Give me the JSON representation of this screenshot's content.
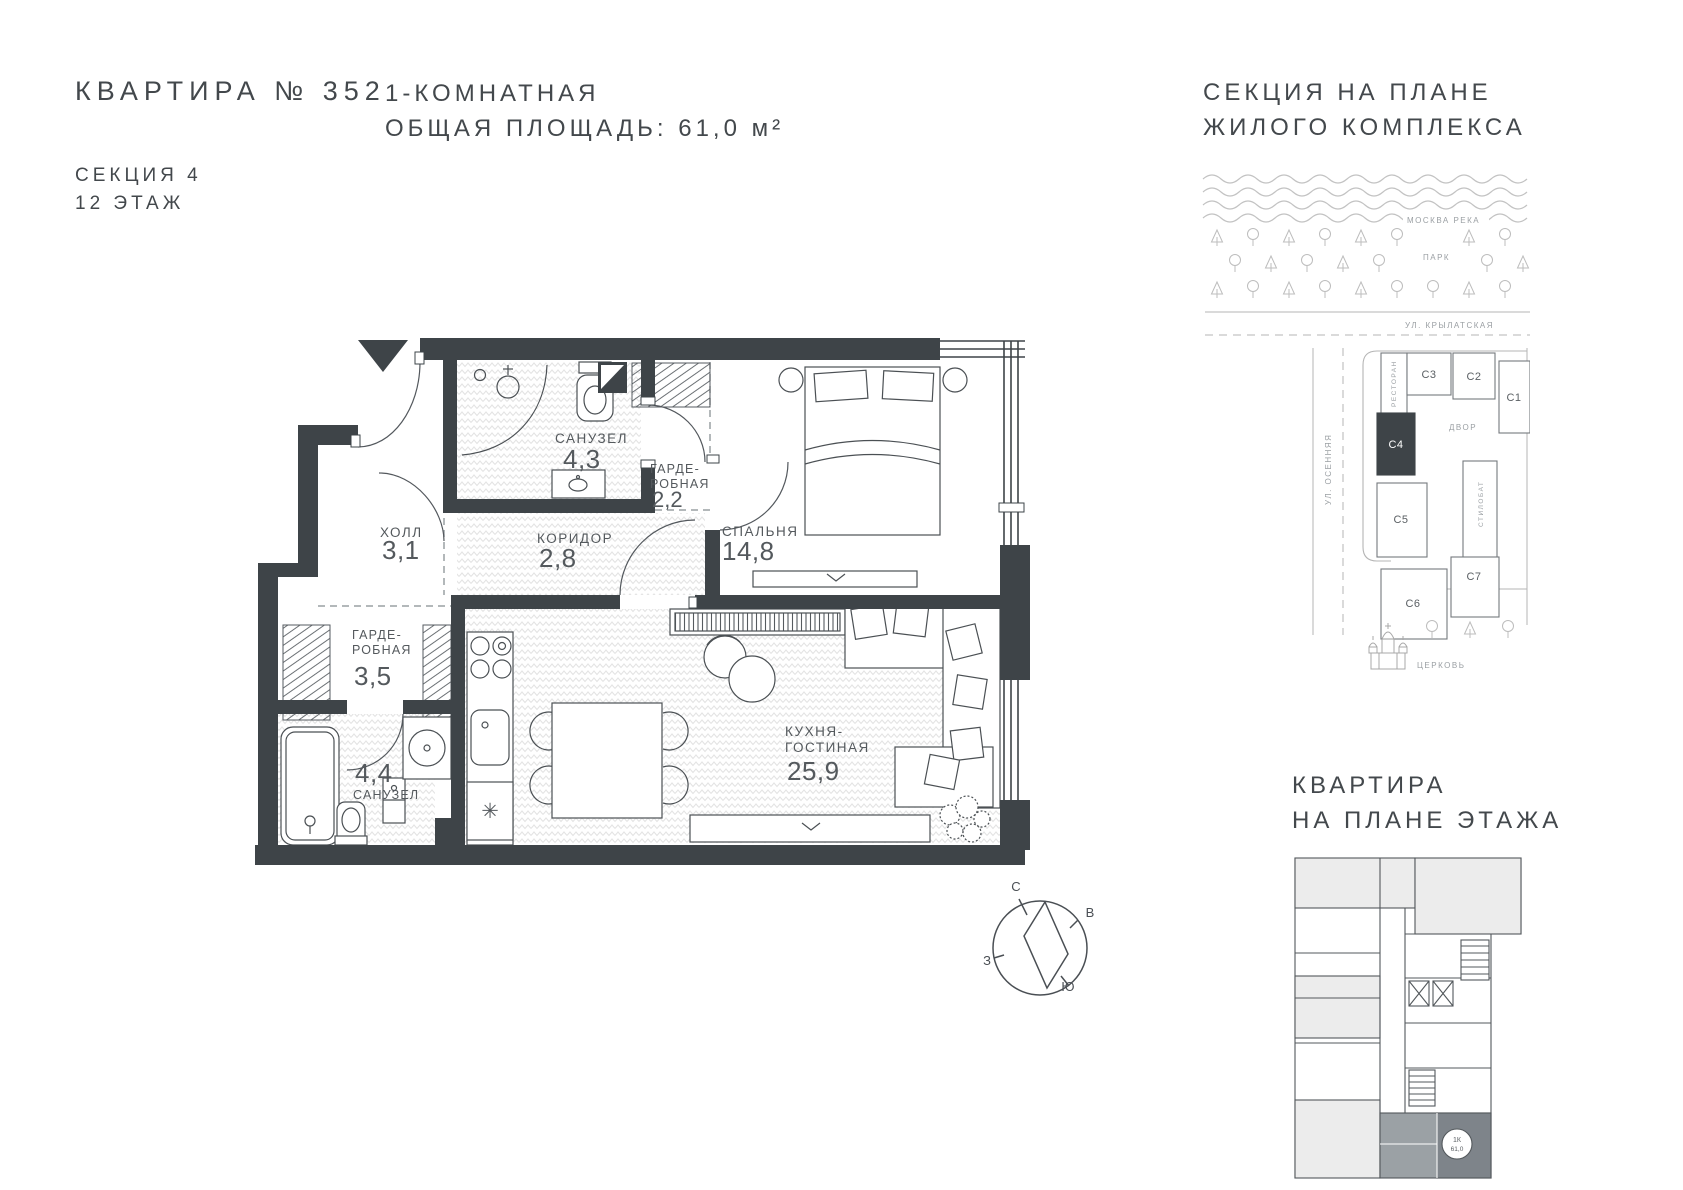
{
  "header": {
    "apartment_number": "КВАРТИРА № 352",
    "section": "СЕКЦИЯ 4",
    "floor": "12 ЭТАЖ",
    "type": "1-КОМНАТНАЯ",
    "total_area": "ОБЩАЯ ПЛОЩАДЬ: 61,0 м²",
    "site_plan_title_1": "СЕКЦИЯ НА ПЛАНЕ",
    "site_plan_title_2": "ЖИЛОГО КОМПЛЕКСА"
  },
  "plan": {
    "view_label": "ВИД: ДВОР",
    "fridge_symbol": "✳",
    "rooms": {
      "hall": {
        "name": "ХОЛЛ",
        "area": "3,1"
      },
      "bathroom_top": {
        "name": "САНУЗЕЛ",
        "area": "4,3"
      },
      "wardrobe_top": {
        "name_line1": "ГАРДЕ-",
        "name_line2": "РОБНАЯ",
        "area": "2,2"
      },
      "corridor": {
        "name": "КОРИДОР",
        "area": "2,8"
      },
      "bedroom": {
        "name": "СПАЛЬНЯ",
        "area": "14,8"
      },
      "wardrobe_left": {
        "name_line1": "ГАРДЕ-",
        "name_line2": "РОБНАЯ",
        "area": "3,5"
      },
      "bathroom_bottom": {
        "name": "САНУЗЕЛ",
        "area": "4,4"
      },
      "kitchen_living": {
        "name_line1": "КУХНЯ-",
        "name_line2": "ГОСТИНАЯ",
        "area": "25,9"
      }
    }
  },
  "site_map": {
    "river": "МОСКВА РЕКА",
    "park": "ПАРК",
    "street_top": "УЛ. КРЫЛАТСКАЯ",
    "street_left": "УЛ. ОСЕННЯЯ",
    "restaurant": "РЕСТОРАН",
    "courtyard": "ДВОР",
    "stylobate": "СТИЛОБАТ",
    "church": "ЦЕРКОВЬ",
    "sections": {
      "c1": "С1",
      "c2": "С2",
      "c3": "С3",
      "c4": "С4",
      "c5": "С5",
      "c6": "С6",
      "c7": "С7"
    }
  },
  "floor_thumb": {
    "title_1": "КВАРТИРА",
    "title_2": "НА ПЛАНЕ ЭТАЖА",
    "badge_line_1": "1К",
    "badge_line_2": "61,0"
  },
  "compass": {
    "north": "С",
    "east": "В",
    "west": "З",
    "south": "Ю"
  },
  "colors": {
    "wall": "#3E4448",
    "line_gray": "#9b9b9b",
    "map_line": "#b9b9b9",
    "label": "#54595d",
    "thumb_highlight": "#9ba1a5"
  }
}
